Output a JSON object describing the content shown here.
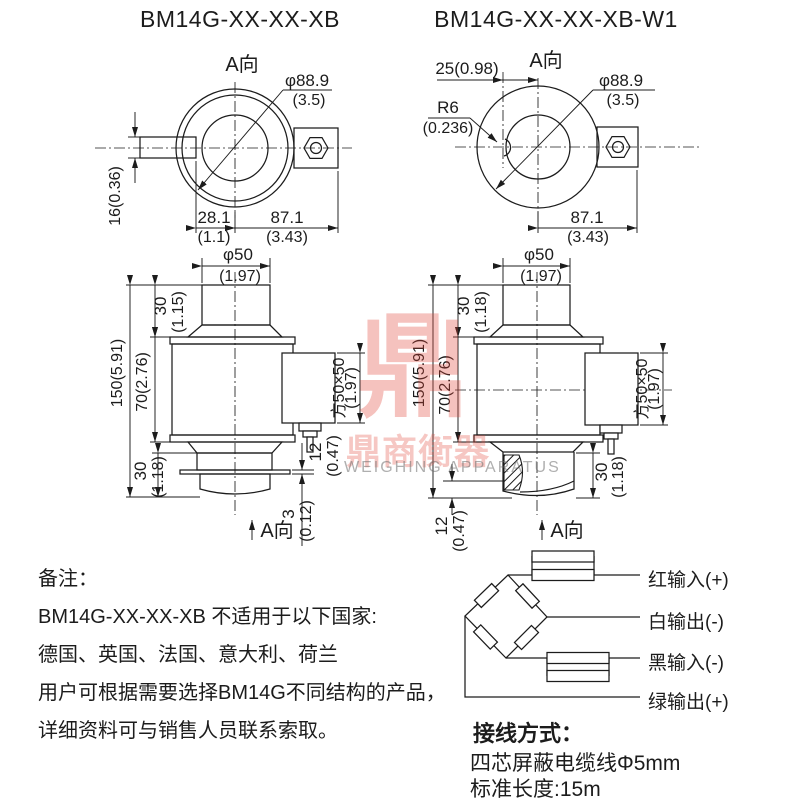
{
  "titles": {
    "left_model": "BM14G-XX-XX-XB",
    "right_model": "BM14G-XX-XX-XB-W1"
  },
  "labels": {
    "view_a": "A向"
  },
  "dims": {
    "left_top": {
      "dia": "φ88.9",
      "dia_in": "(3.5)",
      "thickness": "16(0.36)",
      "offset": "28.1",
      "offset_in": "(1.1)",
      "span": "87.1",
      "span_in": "(3.43)"
    },
    "right_top": {
      "dia": "φ88.9",
      "dia_in": "(3.5)",
      "offset25": "25(0.98)",
      "radius": "R6",
      "radius_in": "(0.236)",
      "span": "87.1",
      "span_in": "(3.43)"
    },
    "left_side": {
      "cap_dia": "φ50",
      "cap_dia_in": "(1.97)",
      "cap_h": "30",
      "cap_h_in": "(1.15)",
      "total": "150(5.91)",
      "mid": "70(2.76)",
      "box": "方50×50",
      "box_in": "(1.97)",
      "stub": "12",
      "stub_in": "(0.47)",
      "plate": "3",
      "plate_in": "(0.12)",
      "lower": "30",
      "lower_in": "(1.18)"
    },
    "right_side": {
      "cap_dia": "φ50",
      "cap_dia_in": "(1.97)",
      "cap_h": "30",
      "cap_h_in": "(1.18)",
      "total": "150(5.91)",
      "mid": "70(2.76)",
      "box": "方50×50",
      "box_in": "(1.97)",
      "seat": "12",
      "seat_in": "(0.47)",
      "lower": "30",
      "lower_in": "(1.18)"
    }
  },
  "notes": {
    "lines": [
      "备注：",
      "BM14G-XX-XX-XB 不适用于以下国家:",
      "德国、英国、法国、意大利、荷兰",
      "用户可根据需要选择BM14G不同结构的产品，",
      "详细资料可与销售人员联系索取。"
    ]
  },
  "wiring": {
    "title": "接线方式：",
    "cable": "四芯屏蔽电缆线Φ5mm",
    "length": "标准长度:15m",
    "wires": [
      "红输入(+)",
      "白输出(-)",
      "黑输入(-)",
      "绿输出(+)"
    ]
  },
  "watermark": {
    "glyph": "鼎",
    "brand": "鼎商衡器",
    "sub": "WEIGHING APPARATUS"
  }
}
